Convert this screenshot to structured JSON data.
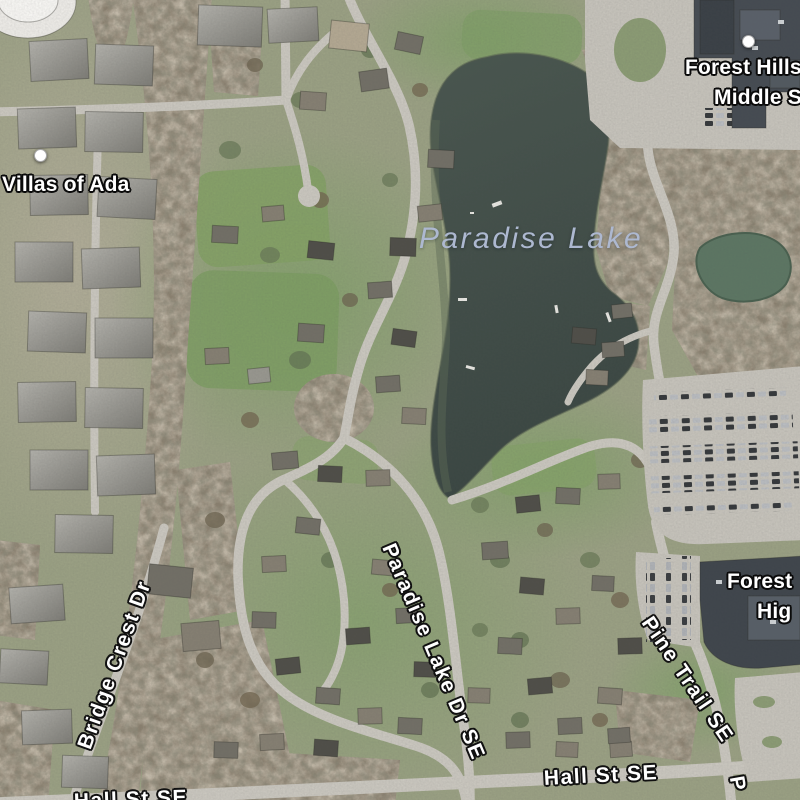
{
  "map": {
    "type": "satellite",
    "labels": {
      "villas_of_ada": "Villas of Ada",
      "forest_hills_middle_line1": "Forest Hills",
      "forest_hills_middle_line2": "Middle S",
      "forest_hills_high_line1": "Forest",
      "forest_hills_high_line2": "Hig",
      "water_paradise_lake": "Paradise Lake",
      "bridge_crest_dr": "Bridge Crest Dr",
      "paradise_lake_dr_se": "Paradise Lake Dr SE",
      "pine_trail_se": "Pine Trail SE",
      "hall_st_se": "Hall St SE",
      "hall_st_se_left": "Hall St SE",
      "partial_street_p": "P"
    },
    "icons": {
      "poi_marker": "white-dot"
    },
    "colors": {
      "water": "#3e4b47",
      "pond": "#5c7663",
      "water_label": "#adb8d0",
      "road": "#cac7bf",
      "woods": "#8b8170",
      "grass_base": "#9aa083",
      "lawn_green": "#7f9d66",
      "parking": "#c6c3bb",
      "school_roof": "#434a51",
      "street_label": "#ffffff",
      "label_halo": "#111111"
    }
  }
}
